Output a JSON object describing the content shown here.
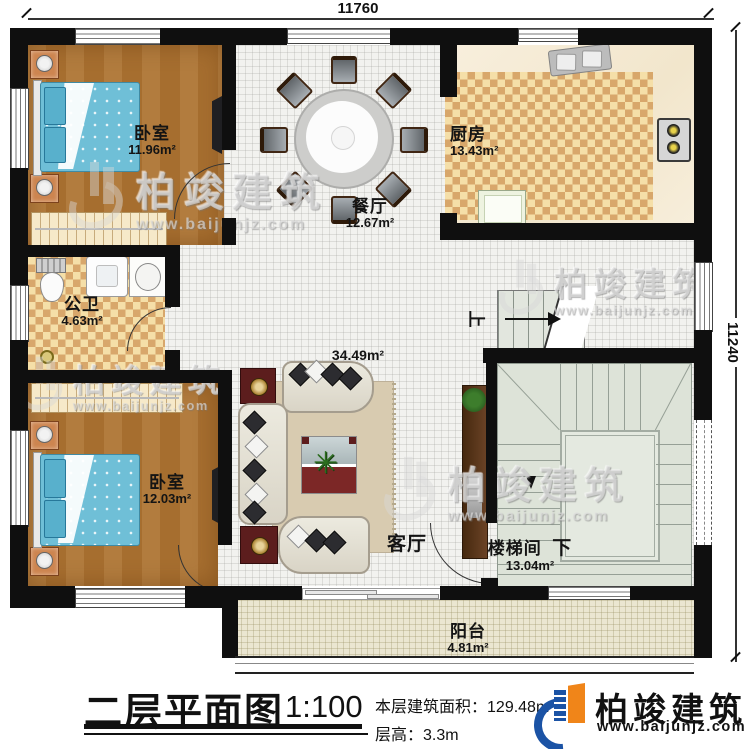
{
  "dimensions": {
    "top": "11760",
    "right": "11240"
  },
  "rooms": [
    {
      "name": "卧室",
      "area": "11.96m²"
    },
    {
      "name": "餐厅",
      "area": "12.67m²"
    },
    {
      "name": "厨房",
      "area": "13.43m²"
    },
    {
      "name": "公卫",
      "area": "4.63m²"
    },
    {
      "name": "客厅",
      "area": "34.49m²"
    },
    {
      "name": "卧室",
      "area": "12.03m²"
    },
    {
      "name": "楼梯间",
      "area": "13.04m²"
    },
    {
      "name": "阳台",
      "area": "4.81m²"
    }
  ],
  "stairs": {
    "up_label": "上",
    "down_label": "下"
  },
  "title_block": {
    "title": "二层平面图",
    "scale": "1:100",
    "floor_area_label": "本层建筑面积：",
    "floor_area": "129.48m²",
    "floor_height_label": "层高：",
    "floor_height": "3.3m"
  },
  "brand": {
    "name": "柏竣建筑",
    "website": "www.baijunjz.com"
  },
  "colors": {
    "wall": "#0f0f0f",
    "wood": "#ad7536",
    "checker": "#d8a76b",
    "stair": "#dde3d8",
    "bed": "#6fbfd7",
    "logo_blue": "#1b53a5",
    "logo_orange": "#f08519"
  }
}
